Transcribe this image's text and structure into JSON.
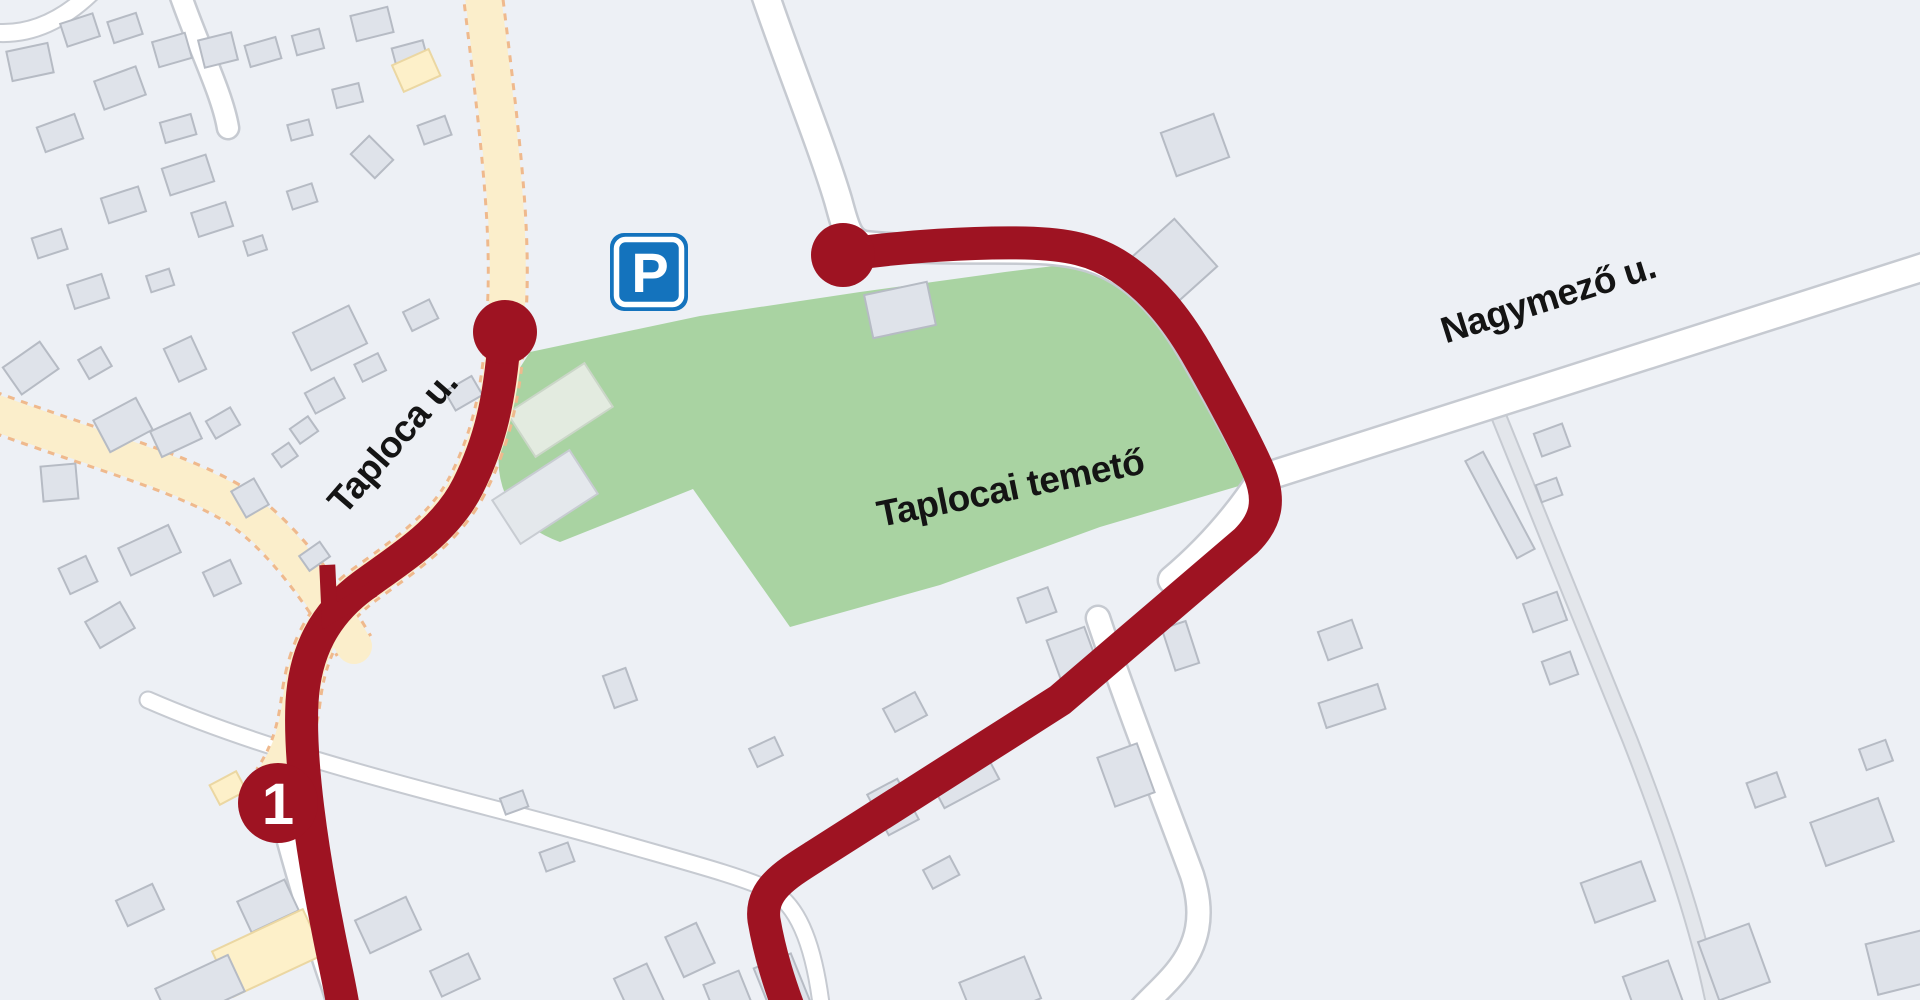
{
  "labels": {
    "street_taploca": "Taploca u.",
    "street_nagymezo": "Nagymező u.",
    "area_cemetery": "Taplocai temető"
  },
  "markers": {
    "stop": {
      "number": "1"
    },
    "parking": {
      "letter": "P"
    }
  },
  "colors": {
    "bg": "#edf0f5",
    "green": "#a9d3a2",
    "route": "#9e1322",
    "road": "#ffffff",
    "casing": "#c6cad1",
    "cream": "#fbeecb",
    "cream-edge": "#efb98d",
    "track": "#e3e6eb",
    "bld": "#dfe3ea",
    "bld-edge": "#b6bbc4",
    "bld-light": "#e3ebe0",
    "bld-light-edge": "#cbd6c8",
    "bld-cream": "#fdf0c9",
    "bld-cream-edge": "#ebd7a2",
    "psign": "#1473bd"
  }
}
